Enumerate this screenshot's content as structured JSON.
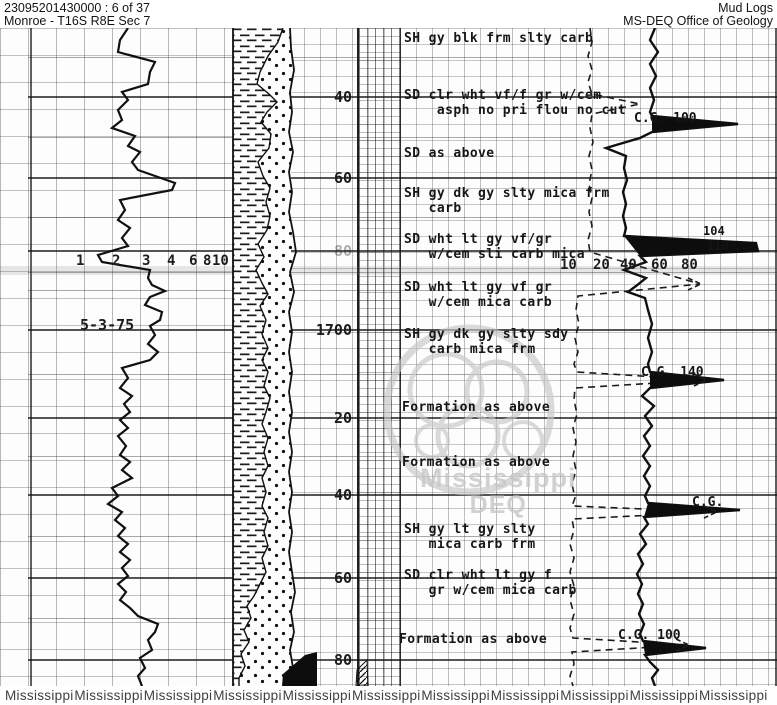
{
  "colors": {
    "paper": "#fdfdfd",
    "ink": "#161616",
    "grid_line": "#8a8a8a",
    "watermark_gray": "#c7c7c7",
    "footer_text": "#3f3f3f"
  },
  "header": {
    "doc_id": "23095201430000 : 6 of 37",
    "location": "Monroe - T16S R8E Sec 7",
    "log_type": "Mud Logs",
    "agency": "MS-DEQ Office of Geology"
  },
  "left_track": {
    "date": "5-3-75",
    "scale": [
      {
        "label": "1",
        "x": 76
      },
      {
        "label": "2",
        "x": 112
      },
      {
        "label": "3",
        "x": 142
      },
      {
        "label": "4",
        "x": 167
      },
      {
        "label": "6",
        "x": 189
      },
      {
        "label": "8",
        "x": 203
      },
      {
        "label": "10",
        "x": 212
      }
    ],
    "scale_y": 253
  },
  "right_track": {
    "scale": [
      {
        "label": "10",
        "x": 560
      },
      {
        "label": "20",
        "x": 593
      },
      {
        "label": "40",
        "x": 620
      },
      {
        "label": "60",
        "x": 651
      },
      {
        "label": "80",
        "x": 681
      }
    ],
    "scale_y": 257,
    "annotations": [
      {
        "text": "C.G. 100",
        "x": 634,
        "y": 111
      },
      {
        "text": "104",
        "x": 703,
        "y": 224,
        "small": true
      },
      {
        "text": "110",
        "x": 707,
        "y": 239,
        "small": true
      },
      {
        "text": "C.G. 140",
        "x": 641,
        "y": 365
      },
      {
        "text": "C.G.",
        "x": 692,
        "y": 495
      },
      {
        "text": "C.G. 100",
        "x": 618,
        "y": 628
      }
    ]
  },
  "depth_track": {
    "labels": [
      {
        "text": "40",
        "y": 97
      },
      {
        "text": "60",
        "y": 178
      },
      {
        "text": "80",
        "y": 251,
        "faded": true
      },
      {
        "text": "1700",
        "y": 330
      },
      {
        "text": "20",
        "y": 418
      },
      {
        "text": "40",
        "y": 495
      },
      {
        "text": "60",
        "y": 578
      },
      {
        "text": "80",
        "y": 660
      }
    ]
  },
  "descriptions": [
    {
      "x": 404,
      "y": 31,
      "lines": [
        "SH gy blk frm slty carb"
      ]
    },
    {
      "x": 404,
      "y": 88,
      "lines": [
        "SD clr wht vf/f gr w/cem",
        "    asph no pri flou no cut"
      ]
    },
    {
      "x": 404,
      "y": 146,
      "lines": [
        "SD as above"
      ]
    },
    {
      "x": 404,
      "y": 186,
      "lines": [
        "SH gy dk gy slty mica frm",
        "   carb"
      ]
    },
    {
      "x": 404,
      "y": 232,
      "lines": [
        "SD wht lt gy vf/gr",
        "   w/cem sli carb mica"
      ]
    },
    {
      "x": 404,
      "y": 280,
      "lines": [
        "SD wht lt gy vf gr",
        "   w/cem mica carb"
      ]
    },
    {
      "x": 404,
      "y": 327,
      "lines": [
        "SH gy dk gy slty sdy",
        "   carb mica frm"
      ]
    },
    {
      "x": 402,
      "y": 400,
      "lines": [
        "Formation as above"
      ]
    },
    {
      "x": 402,
      "y": 455,
      "lines": [
        "Formation as above"
      ]
    },
    {
      "x": 404,
      "y": 522,
      "lines": [
        "SH gy lt gy slty",
        "   mica carb frm"
      ]
    },
    {
      "x": 404,
      "y": 568,
      "lines": [
        "SD clr wht lt gy f",
        "   gr w/cem mica carb"
      ]
    },
    {
      "x": 399,
      "y": 632,
      "lines": [
        "Formation as above"
      ]
    }
  ],
  "watermark": {
    "line1": "Mississippi",
    "line2": "DEQ"
  },
  "footer": {
    "word": "Mississippi",
    "count": 11
  },
  "grid": {
    "heavy_lines_y": [
      97,
      178,
      251,
      330,
      418,
      495,
      578,
      660
    ],
    "medium_lines_y": [
      57,
      137,
      217,
      272,
      290,
      374,
      456,
      536,
      618
    ],
    "vertical_lines_x": [
      30,
      775
    ]
  },
  "curves": {
    "left": [
      [
        128,
        28
      ],
      [
        120,
        40
      ],
      [
        118,
        52
      ],
      [
        155,
        62
      ],
      [
        150,
        72
      ],
      [
        148,
        84
      ],
      [
        122,
        92
      ],
      [
        128,
        100
      ],
      [
        118,
        110
      ],
      [
        122,
        120
      ],
      [
        112,
        128
      ],
      [
        135,
        136
      ],
      [
        128,
        146
      ],
      [
        140,
        152
      ],
      [
        132,
        162
      ],
      [
        138,
        170
      ],
      [
        175,
        183
      ],
      [
        172,
        190
      ],
      [
        120,
        200
      ],
      [
        125,
        210
      ],
      [
        118,
        220
      ],
      [
        130,
        228
      ],
      [
        122,
        238
      ],
      [
        128,
        246
      ],
      [
        98,
        255
      ],
      [
        102,
        262
      ],
      [
        150,
        270
      ],
      [
        148,
        278
      ],
      [
        152,
        285
      ],
      [
        165,
        291
      ],
      [
        150,
        297
      ],
      [
        145,
        305
      ],
      [
        162,
        312
      ],
      [
        160,
        320
      ],
      [
        150,
        326
      ],
      [
        155,
        335
      ],
      [
        148,
        344
      ],
      [
        158,
        352
      ],
      [
        150,
        360
      ],
      [
        122,
        368
      ],
      [
        128,
        378
      ],
      [
        120,
        388
      ],
      [
        132,
        396
      ],
      [
        124,
        404
      ],
      [
        130,
        412
      ],
      [
        120,
        420
      ],
      [
        128,
        428
      ],
      [
        118,
        436
      ],
      [
        126,
        446
      ],
      [
        120,
        455
      ],
      [
        130,
        462
      ],
      [
        122,
        470
      ],
      [
        132,
        478
      ],
      [
        112,
        488
      ],
      [
        118,
        496
      ],
      [
        108,
        504
      ],
      [
        122,
        512
      ],
      [
        115,
        520
      ],
      [
        125,
        528
      ],
      [
        118,
        536
      ],
      [
        128,
        544
      ],
      [
        120,
        552
      ],
      [
        130,
        560
      ],
      [
        122,
        568
      ],
      [
        128,
        576
      ],
      [
        118,
        584
      ],
      [
        126,
        592
      ],
      [
        120,
        600
      ],
      [
        130,
        608
      ],
      [
        138,
        616
      ],
      [
        158,
        624
      ],
      [
        155,
        632
      ],
      [
        148,
        640
      ],
      [
        152,
        650
      ],
      [
        140,
        658
      ],
      [
        145,
        668
      ],
      [
        138,
        676
      ],
      [
        142,
        686
      ]
    ],
    "solid": [
      [
        655,
        28
      ],
      [
        650,
        40
      ],
      [
        658,
        52
      ],
      [
        650,
        64
      ],
      [
        656,
        76
      ],
      [
        650,
        88
      ],
      [
        654,
        100
      ],
      [
        650,
        112
      ],
      [
        652,
        116
      ],
      [
        738,
        124
      ],
      [
        652,
        132
      ],
      [
        640,
        138
      ],
      [
        606,
        148
      ],
      [
        626,
        156
      ],
      [
        624,
        168
      ],
      [
        627,
        180
      ],
      [
        623,
        192
      ],
      [
        626,
        204
      ],
      [
        623,
        216
      ],
      [
        626,
        228
      ],
      [
        624,
        236
      ],
      [
        756,
        243
      ],
      [
        758,
        251
      ],
      [
        640,
        256
      ],
      [
        646,
        262
      ],
      [
        624,
        270
      ],
      [
        646,
        278
      ],
      [
        636,
        286
      ],
      [
        628,
        292
      ],
      [
        645,
        298
      ],
      [
        648,
        310
      ],
      [
        652,
        324
      ],
      [
        648,
        338
      ],
      [
        652,
        352
      ],
      [
        648,
        364
      ],
      [
        650,
        372
      ],
      [
        724,
        380
      ],
      [
        650,
        388
      ],
      [
        642,
        396
      ],
      [
        654,
        406
      ],
      [
        645,
        416
      ],
      [
        652,
        426
      ],
      [
        644,
        436
      ],
      [
        650,
        446
      ],
      [
        643,
        456
      ],
      [
        650,
        466
      ],
      [
        644,
        476
      ],
      [
        650,
        486
      ],
      [
        645,
        496
      ],
      [
        648,
        503
      ],
      [
        740,
        510
      ],
      [
        644,
        517
      ],
      [
        648,
        524
      ],
      [
        640,
        534
      ],
      [
        646,
        544
      ],
      [
        638,
        554
      ],
      [
        643,
        564
      ],
      [
        637,
        574
      ],
      [
        642,
        584
      ],
      [
        638,
        594
      ],
      [
        643,
        604
      ],
      [
        639,
        614
      ],
      [
        644,
        624
      ],
      [
        640,
        634
      ],
      [
        643,
        641
      ],
      [
        706,
        648
      ],
      [
        645,
        655
      ],
      [
        650,
        662
      ],
      [
        658,
        670
      ],
      [
        652,
        678
      ],
      [
        655,
        686
      ]
    ],
    "dashed": [
      [
        590,
        28
      ],
      [
        592,
        42
      ],
      [
        588,
        56
      ],
      [
        592,
        70
      ],
      [
        588,
        82
      ],
      [
        592,
        94
      ],
      [
        640,
        104
      ],
      [
        592,
        114
      ],
      [
        590,
        128
      ],
      [
        593,
        142
      ],
      [
        589,
        156
      ],
      [
        592,
        170
      ],
      [
        589,
        184
      ],
      [
        592,
        198
      ],
      [
        589,
        212
      ],
      [
        592,
        226
      ],
      [
        588,
        240
      ],
      [
        590,
        252
      ],
      [
        700,
        284
      ],
      [
        578,
        296
      ],
      [
        576,
        310
      ],
      [
        579,
        324
      ],
      [
        575,
        338
      ],
      [
        578,
        352
      ],
      [
        574,
        364
      ],
      [
        577,
        372
      ],
      [
        706,
        380
      ],
      [
        575,
        388
      ],
      [
        574,
        400
      ],
      [
        577,
        414
      ],
      [
        573,
        428
      ],
      [
        576,
        442
      ],
      [
        573,
        456
      ],
      [
        576,
        470
      ],
      [
        572,
        484
      ],
      [
        575,
        498
      ],
      [
        572,
        506
      ],
      [
        716,
        512
      ],
      [
        572,
        519
      ],
      [
        574,
        530
      ],
      [
        570,
        544
      ],
      [
        574,
        558
      ],
      [
        570,
        572
      ],
      [
        574,
        586
      ],
      [
        570,
        600
      ],
      [
        574,
        614
      ],
      [
        570,
        628
      ],
      [
        573,
        638
      ],
      [
        688,
        645
      ],
      [
        572,
        652
      ],
      [
        574,
        664
      ],
      [
        570,
        676
      ],
      [
        573,
        686
      ]
    ],
    "spikes": [
      [
        [
          652,
          116
        ],
        [
          738,
          124
        ],
        [
          652,
          132
        ]
      ],
      [
        [
          624,
          236
        ],
        [
          756,
          243
        ],
        [
          758,
          251
        ],
        [
          640,
          256
        ]
      ],
      [
        [
          650,
          372
        ],
        [
          724,
          380
        ],
        [
          650,
          388
        ]
      ],
      [
        [
          648,
          503
        ],
        [
          740,
          510
        ],
        [
          644,
          517
        ]
      ],
      [
        [
          643,
          641
        ],
        [
          706,
          648
        ],
        [
          645,
          655
        ]
      ]
    ],
    "arrow_tips": [
      [
        700,
        284
      ],
      [
        706,
        380
      ],
      [
        716,
        512
      ],
      [
        688,
        645
      ]
    ]
  },
  "lithology": {
    "left_edge_x": 233,
    "boundary": [
      [
        283,
        28
      ],
      [
        278,
        42
      ],
      [
        268,
        56
      ],
      [
        260,
        72
      ],
      [
        257,
        84
      ],
      [
        269,
        94
      ],
      [
        277,
        102
      ],
      [
        267,
        112
      ],
      [
        261,
        122
      ],
      [
        271,
        134
      ],
      [
        269,
        148
      ],
      [
        258,
        162
      ],
      [
        263,
        176
      ],
      [
        270,
        188
      ],
      [
        266,
        202
      ],
      [
        270,
        216
      ],
      [
        267,
        230
      ],
      [
        258,
        244
      ],
      [
        264,
        257
      ],
      [
        256,
        270
      ],
      [
        262,
        283
      ],
      [
        268,
        294
      ],
      [
        260,
        306
      ],
      [
        266,
        320
      ],
      [
        262,
        334
      ],
      [
        268,
        348
      ],
      [
        262,
        360
      ],
      [
        268,
        372
      ],
      [
        264,
        386
      ],
      [
        270,
        398
      ],
      [
        266,
        412
      ],
      [
        262,
        424
      ],
      [
        268,
        438
      ],
      [
        264,
        452
      ],
      [
        268,
        466
      ],
      [
        262,
        478
      ],
      [
        266,
        492
      ],
      [
        262,
        506
      ],
      [
        268,
        518
      ],
      [
        264,
        532
      ],
      [
        268,
        546
      ],
      [
        262,
        558
      ],
      [
        266,
        572
      ],
      [
        260,
        584
      ],
      [
        254,
        596
      ],
      [
        247,
        606
      ],
      [
        251,
        618
      ],
      [
        244,
        630
      ],
      [
        249,
        642
      ],
      [
        241,
        654
      ],
      [
        245,
        666
      ],
      [
        239,
        678
      ],
      [
        239,
        686
      ]
    ],
    "right_edge": [
      [
        290,
        28
      ],
      [
        291,
        48
      ],
      [
        294,
        70
      ],
      [
        290,
        92
      ],
      [
        292,
        112
      ],
      [
        289,
        132
      ],
      [
        293,
        152
      ],
      [
        289,
        172
      ],
      [
        292,
        192
      ],
      [
        289,
        212
      ],
      [
        293,
        232
      ],
      [
        296,
        252
      ],
      [
        290,
        272
      ],
      [
        294,
        292
      ],
      [
        289,
        312
      ],
      [
        292,
        332
      ],
      [
        289,
        352
      ],
      [
        292,
        372
      ],
      [
        289,
        392
      ],
      [
        292,
        412
      ],
      [
        289,
        432
      ],
      [
        292,
        452
      ],
      [
        289,
        472
      ],
      [
        292,
        492
      ],
      [
        289,
        512
      ],
      [
        292,
        532
      ],
      [
        289,
        552
      ],
      [
        292,
        572
      ],
      [
        295,
        592
      ],
      [
        291,
        612
      ],
      [
        294,
        632
      ],
      [
        290,
        650
      ],
      [
        293,
        668
      ],
      [
        290,
        686
      ]
    ],
    "black_wedge": [
      [
        282,
        686
      ],
      [
        283,
        674
      ],
      [
        305,
        655
      ],
      [
        317,
        652
      ],
      [
        317,
        686
      ]
    ],
    "hatch_wedge": [
      [
        356,
        686
      ],
      [
        357,
        670
      ],
      [
        367,
        660
      ],
      [
        368,
        686
      ]
    ]
  }
}
